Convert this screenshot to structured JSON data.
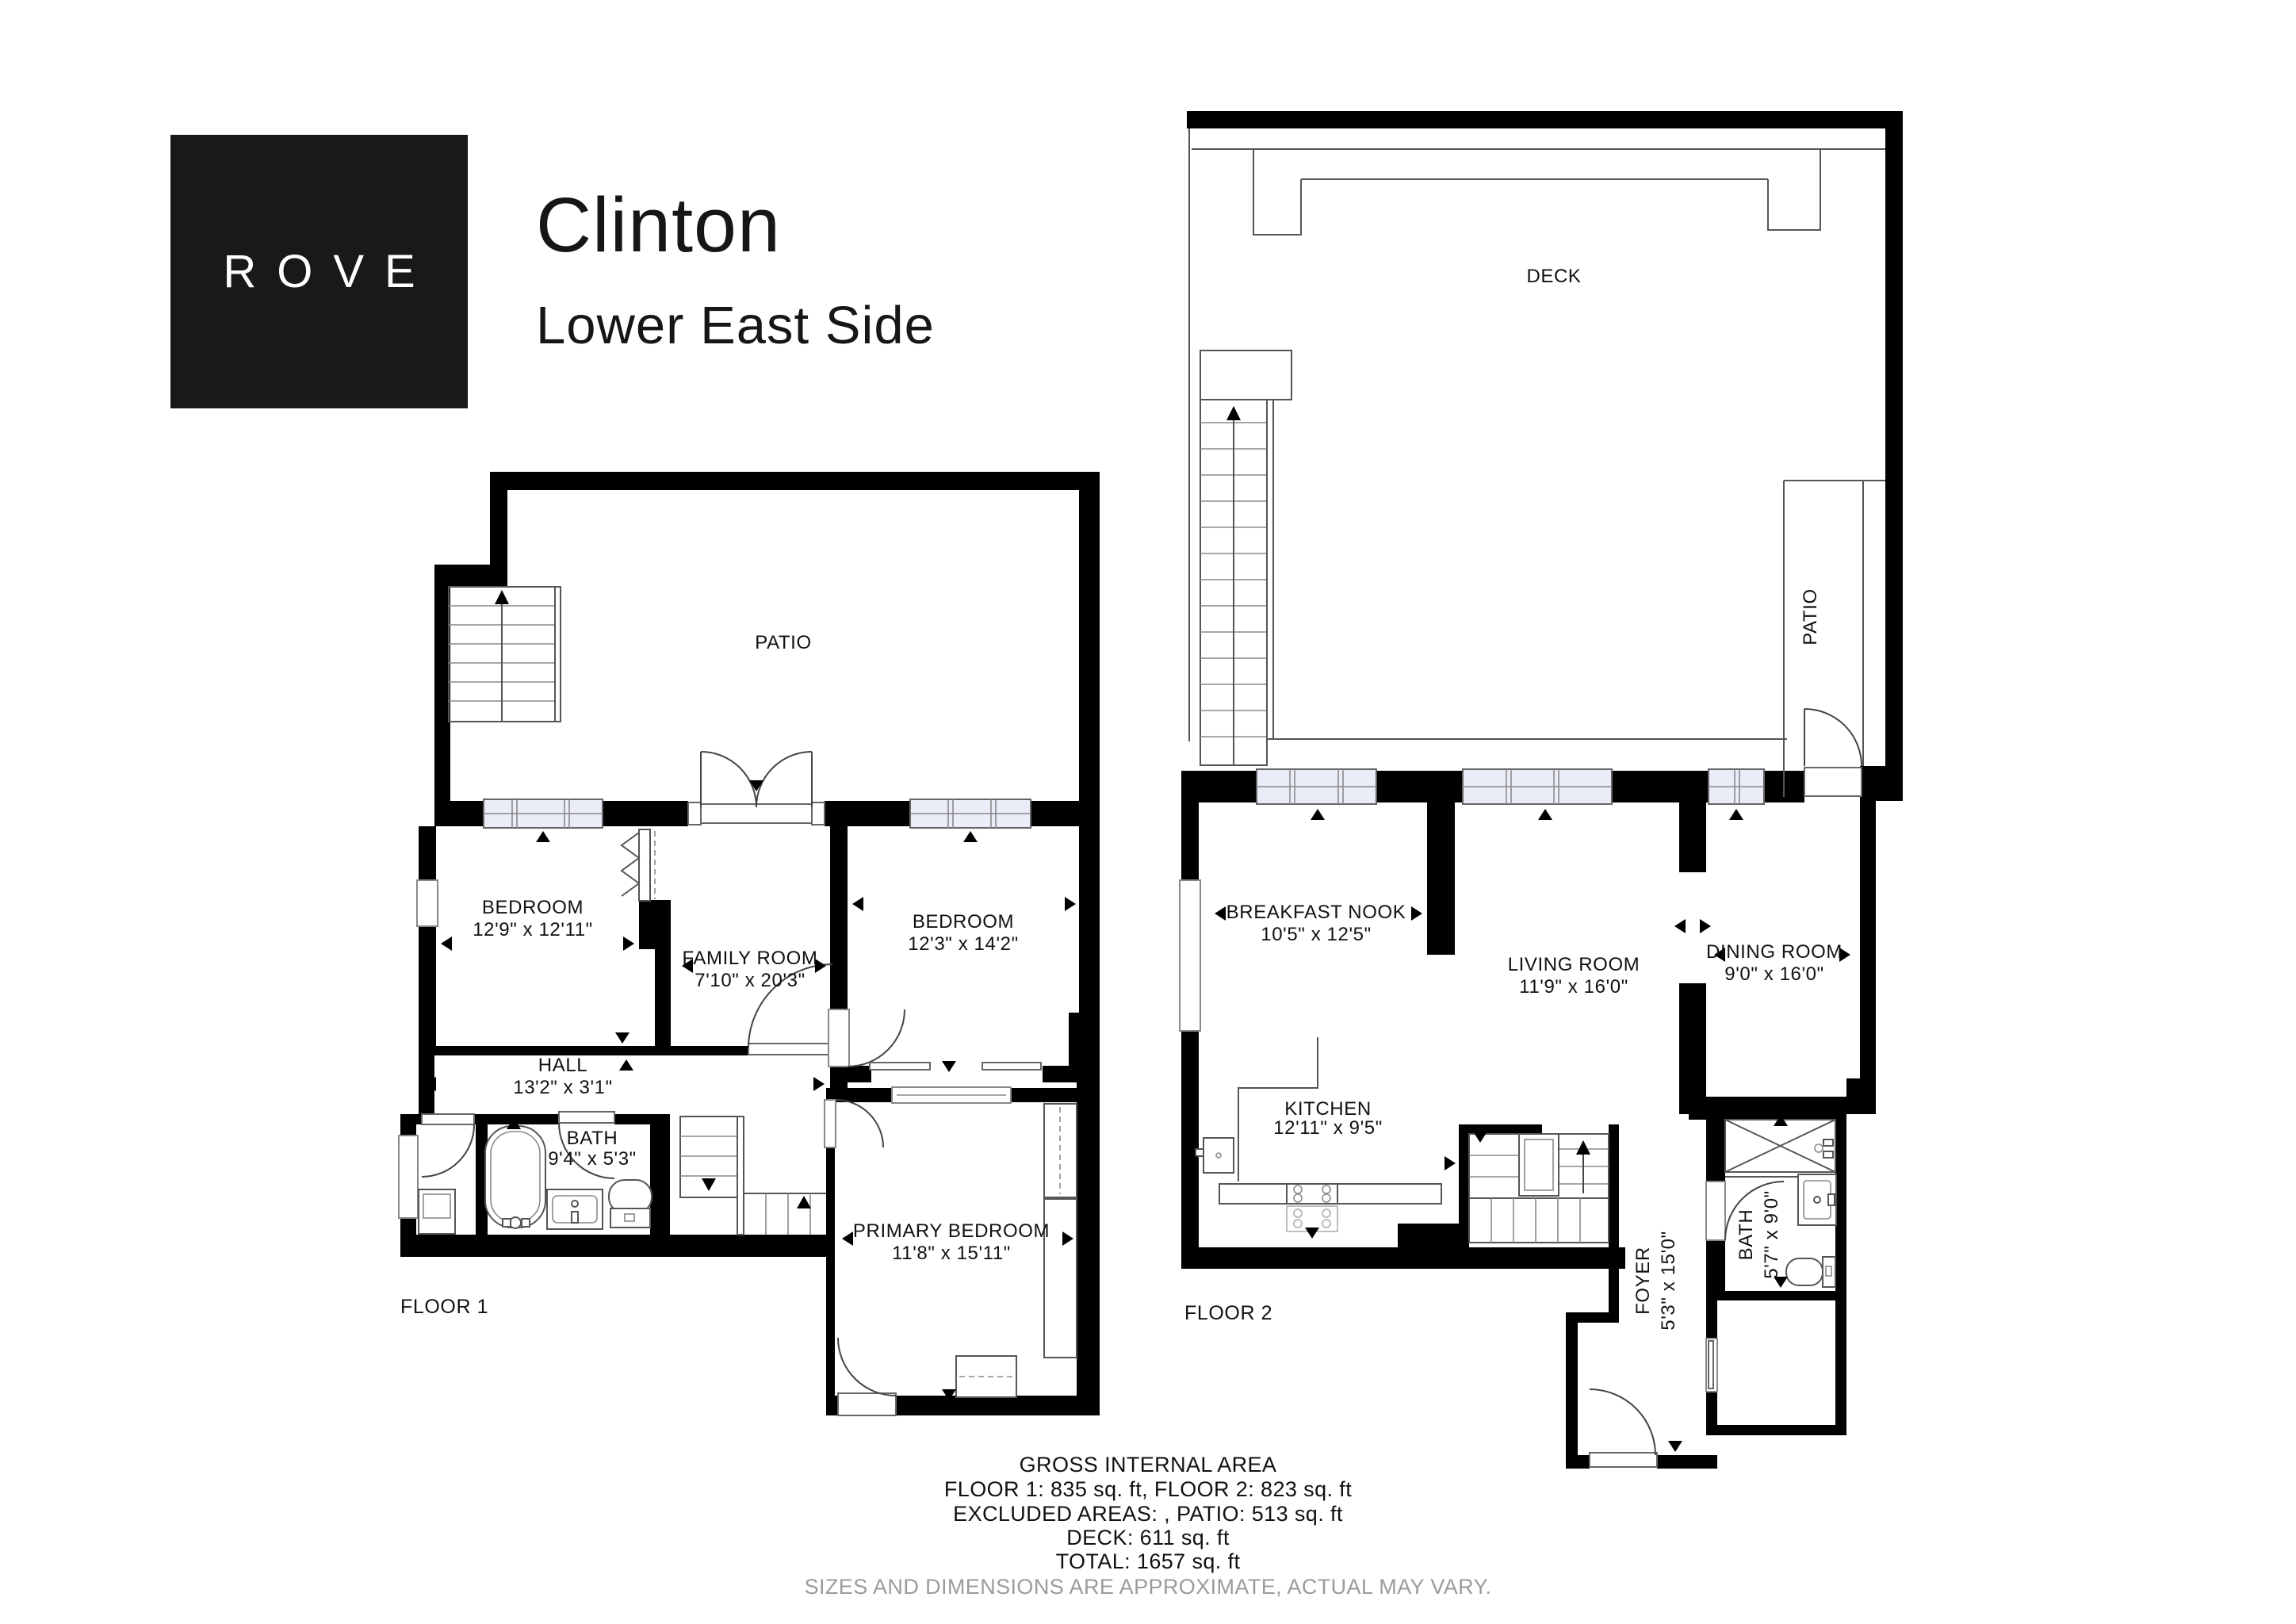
{
  "header": {
    "brand": "ROVE",
    "title": "Clinton",
    "subtitle": "Lower East Side"
  },
  "floor1": {
    "label": "FLOOR 1",
    "patio": {
      "name": "PATIO"
    },
    "bedroom1": {
      "name": "BEDROOM",
      "dims": "12'9\" x 12'11\""
    },
    "family": {
      "name": "FAMILY ROOM",
      "dims": "7'10\" x 20'3\""
    },
    "bedroom2": {
      "name": "BEDROOM",
      "dims": "12'3\" x 14'2\""
    },
    "hall": {
      "name": "HALL",
      "dims": "13'2\" x 3'1\""
    },
    "bath": {
      "name": "BATH",
      "dims": "9'4\" x 5'3\""
    },
    "primary": {
      "name": "PRIMARY BEDROOM",
      "dims": "11'8\" x 15'11\""
    }
  },
  "floor2": {
    "label": "FLOOR 2",
    "deck": {
      "name": "DECK"
    },
    "patio": {
      "name": "PATIO"
    },
    "nook": {
      "name": "BREAKFAST NOOK",
      "dims": "10'5\" x 12'5\""
    },
    "living": {
      "name": "LIVING ROOM",
      "dims": "11'9\" x 16'0\""
    },
    "dining": {
      "name": "DINING ROOM",
      "dims": "9'0\" x 16'0\""
    },
    "kitchen": {
      "name": "KITCHEN",
      "dims": "12'11\" x 9'5\""
    },
    "foyer": {
      "name": "FOYER",
      "dims": "5'3\" x 15'0\""
    },
    "bath": {
      "name": "BATH",
      "dims": "5'7\" x 9'0\""
    }
  },
  "footer": {
    "title": "GROSS INTERNAL AREA",
    "line1": "FLOOR 1: 835 sq. ft, FLOOR 2: 823 sq. ft",
    "line2": "EXCLUDED AREAS: , PATIO: 513 sq. ft",
    "line3": "DECK: 611 sq. ft",
    "line4": "TOTAL: 1657 sq. ft",
    "disclaimer": "SIZES AND DIMENSIONS ARE APPROXIMATE, ACTUAL MAY VARY."
  },
  "colors": {
    "wall": "#000000",
    "window_fill": "#eaecf7",
    "brand_bg": "#191919",
    "disclaimer_text": "#9b9b9b"
  }
}
